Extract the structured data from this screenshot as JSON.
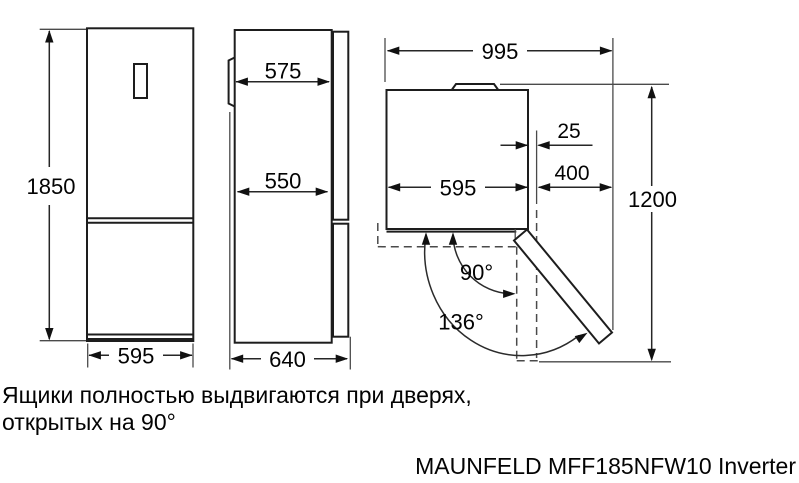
{
  "drawing": {
    "front_view": {
      "height": "1850",
      "width": "595"
    },
    "side_view": {
      "upper_depth": "575",
      "lower_depth": "550",
      "total_depth": "640"
    },
    "top_view": {
      "total_width": "995",
      "hinge_offset": "25",
      "body_width": "595",
      "door_clearance": "400",
      "depth_clearance": "1200",
      "angle_open_90": "90°",
      "angle_open_136": "136°"
    }
  },
  "note": {
    "line1": "Ящики полностью выдвигаются при дверях,",
    "line2": "открытых на 90°"
  },
  "title": "MAUNFELD MFF185NFW10 Inverter",
  "colors": {
    "ink": "#1d1d1d",
    "background": "#ffffff"
  }
}
